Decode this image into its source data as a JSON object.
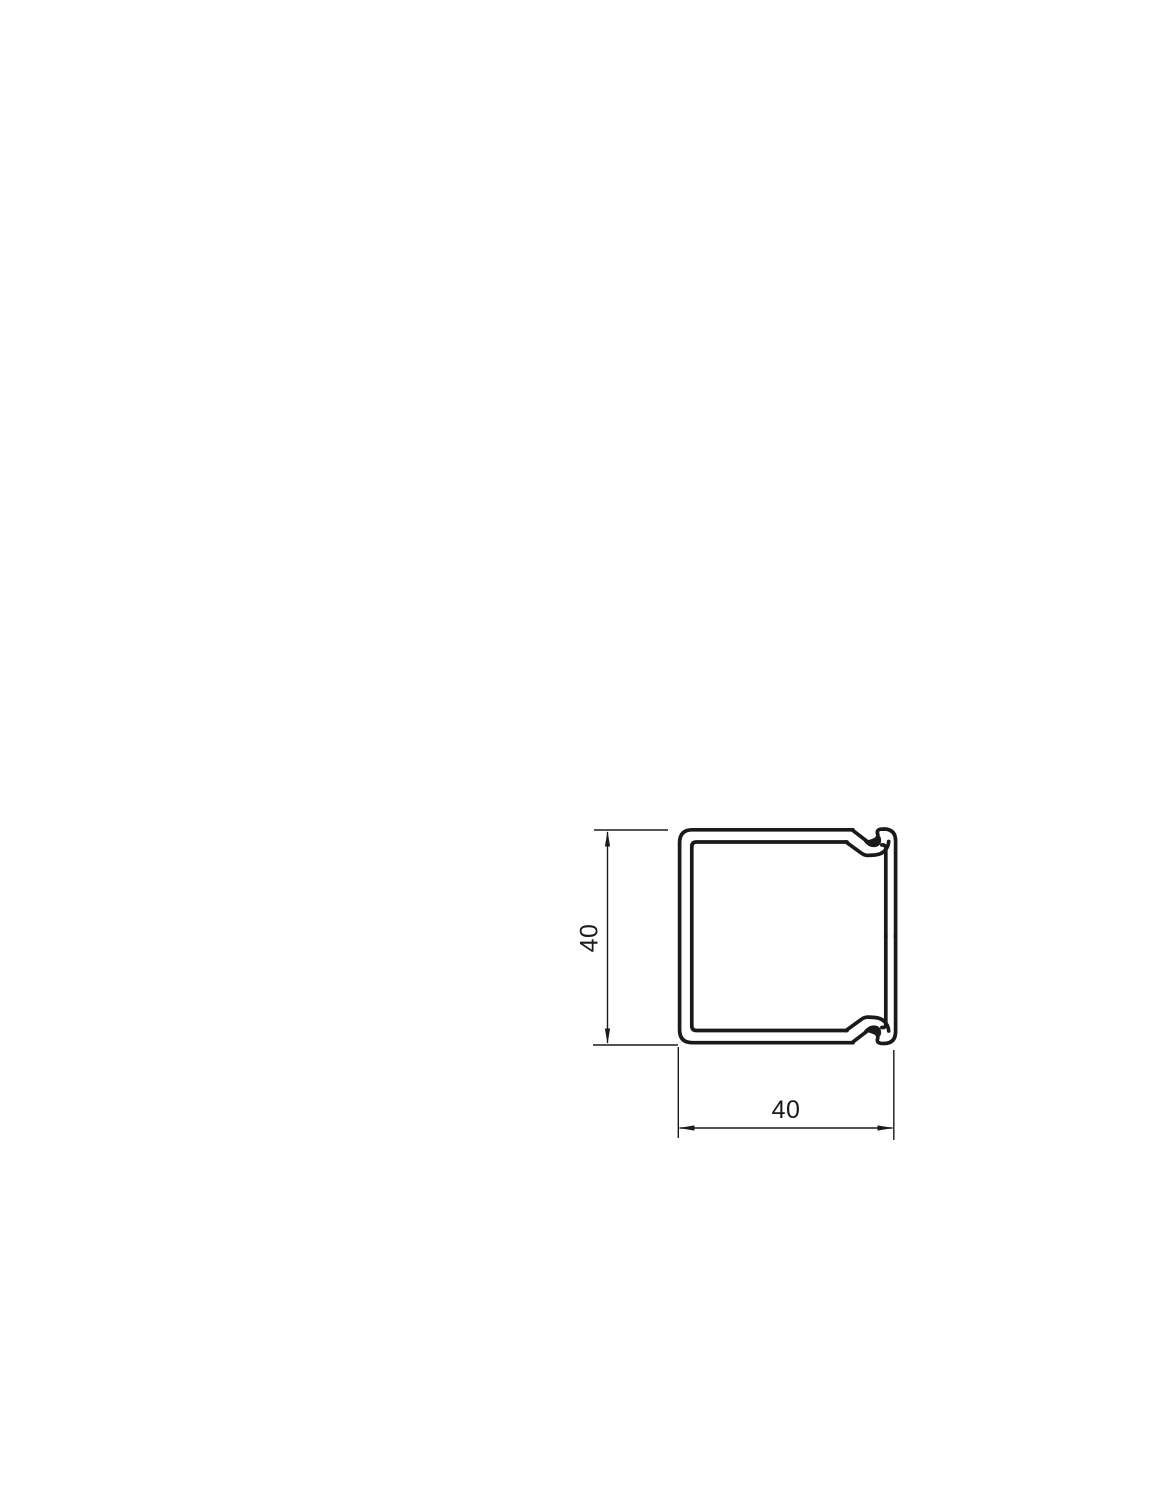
{
  "drawing": {
    "type": "technical-cross-section",
    "subject": "square cable trunking profile with snap-on lid latches",
    "background_color": "#ffffff",
    "line_color": "#1a1a1a",
    "dimensions": {
      "height": {
        "label": "40",
        "orientation": "vertical"
      },
      "width": {
        "label": "40",
        "orientation": "horizontal"
      }
    }
  }
}
